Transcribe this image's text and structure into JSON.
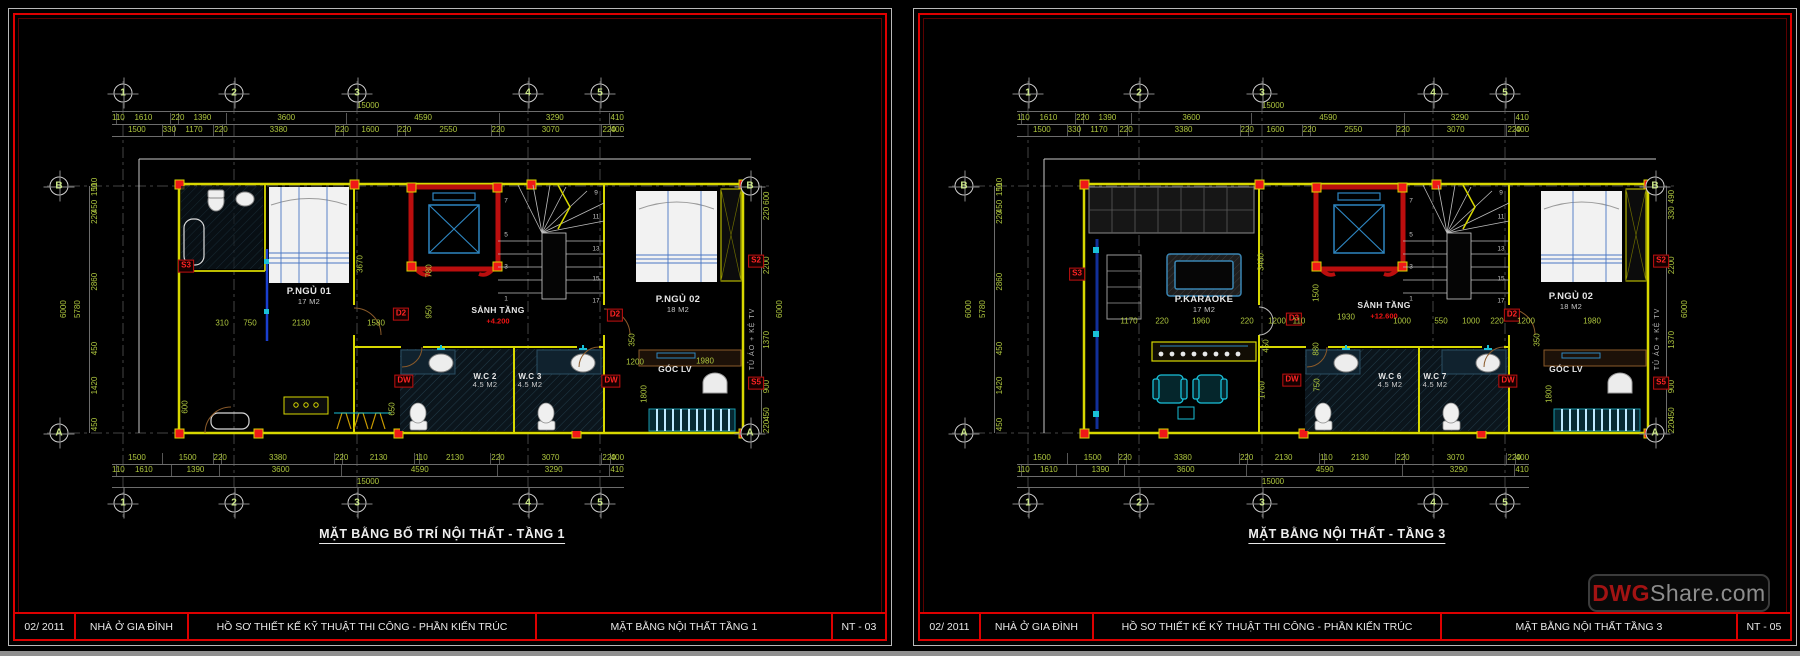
{
  "watermark": {
    "brand": "DWG",
    "suffix": "Share.com"
  },
  "sheets": {
    "left": {
      "plan_title": "MẶT BẰNG BỐ TRÍ NỘI THẤT -  TẦNG 1",
      "titleblock": {
        "date": "02/ 2011",
        "project": "NHÀ Ở GIA ĐÌNH",
        "dossier": "HỒ SƠ THIẾT KẾ KỸ THUẬT THI CÔNG  - PHẦN KIẾN TRÚC",
        "drawing": "MẶT BẰNG NỘI THẤT TẦNG 1",
        "number": "NT - 03"
      },
      "grid": {
        "cols": [
          "1",
          "2",
          "3",
          "4",
          "5"
        ],
        "rows": [
          "B",
          "A"
        ]
      },
      "dims": {
        "top_overall": "15000",
        "top_row2": [
          "110",
          "1610",
          "220",
          "1390",
          "3600",
          "4590",
          "3290",
          "410"
        ],
        "top_row3": [
          "1500",
          "330",
          "1170",
          "220",
          "3380",
          "220",
          "1600",
          "220",
          "2550",
          "220",
          "3070",
          "220",
          "400"
        ],
        "bottom_row1": [
          "1500",
          "1500",
          "220",
          "3380",
          "220",
          "2130",
          "110",
          "2130",
          "220",
          "3070",
          "220",
          "400"
        ],
        "bottom_row2": [
          "110",
          "1610",
          "1390",
          "3600",
          "4590",
          "3290",
          "410"
        ],
        "bottom_overall": "15000",
        "left_overall": [
          "6000",
          "5780"
        ],
        "left_chain": [
          "110",
          "150",
          "450",
          "220",
          "2860",
          "450",
          "1420",
          "450"
        ],
        "right_chain": [
          "600",
          "220",
          "2200",
          "1370",
          "900",
          "450",
          "220"
        ],
        "right_overall": [
          "6000"
        ]
      },
      "placed": [
        {
          "t": "P.NGỦ 01",
          "sub": "17 M2",
          "x": 300,
          "y": 288,
          "c": "room"
        },
        {
          "t": "SẢNH TẦNG",
          "x": 489,
          "y": 302,
          "c": "room small"
        },
        {
          "t": "+4.200",
          "x": 489,
          "y": 313,
          "c": "elev"
        },
        {
          "t": "W.C 2",
          "sub": "4.5 M2",
          "x": 476,
          "y": 372,
          "c": "room wc"
        },
        {
          "t": "W.C 3",
          "sub": "4.5 M2",
          "x": 521,
          "y": 372,
          "c": "room wc"
        },
        {
          "t": "P.NGỦ 02",
          "sub": "18 M2",
          "x": 669,
          "y": 296,
          "c": "room"
        },
        {
          "t": "GÓC LV",
          "x": 666,
          "y": 361,
          "c": "room small"
        },
        {
          "t": "S3",
          "x": 177,
          "y": 257,
          "c": "tag"
        },
        {
          "t": "D2",
          "x": 392,
          "y": 305,
          "c": "tag"
        },
        {
          "t": "D2",
          "x": 606,
          "y": 306,
          "c": "tag"
        },
        {
          "t": "DW",
          "x": 395,
          "y": 372,
          "c": "tag"
        },
        {
          "t": "DW",
          "x": 602,
          "y": 372,
          "c": "tag"
        },
        {
          "t": "S2",
          "x": 747,
          "y": 252,
          "c": "tag"
        },
        {
          "t": "S5",
          "x": 747,
          "y": 374,
          "c": "tag"
        },
        {
          "t": "310",
          "x": 213,
          "y": 314,
          "c": "pdim"
        },
        {
          "t": "750",
          "x": 241,
          "y": 314,
          "c": "pdim"
        },
        {
          "t": "2130",
          "x": 292,
          "y": 314,
          "c": "pdim"
        },
        {
          "t": "1580",
          "x": 367,
          "y": 314,
          "c": "pdim"
        },
        {
          "t": "1200",
          "x": 626,
          "y": 353,
          "c": "pdim"
        },
        {
          "t": "1980",
          "x": 696,
          "y": 352,
          "c": "pdim"
        },
        {
          "t": "3670",
          "x": 351,
          "y": 255,
          "r": 1,
          "c": "pdim"
        },
        {
          "t": "780",
          "x": 420,
          "y": 262,
          "r": 1,
          "c": "pdim"
        },
        {
          "t": "950",
          "x": 420,
          "y": 303,
          "r": 1,
          "c": "pdim"
        },
        {
          "t": "350",
          "x": 623,
          "y": 331,
          "r": 1,
          "c": "pdim"
        },
        {
          "t": "1800",
          "x": 635,
          "y": 385,
          "r": 1,
          "c": "pdim"
        },
        {
          "t": "650",
          "x": 383,
          "y": 400,
          "r": 1,
          "c": "pdim"
        },
        {
          "t": "600",
          "x": 176,
          "y": 398,
          "r": 1,
          "c": "pdim"
        },
        {
          "t": "1",
          "x": 497,
          "y": 290,
          "c": "snum"
        },
        {
          "t": "3",
          "x": 497,
          "y": 258,
          "c": "snum"
        },
        {
          "t": "5",
          "x": 497,
          "y": 226,
          "c": "snum"
        },
        {
          "t": "7",
          "x": 497,
          "y": 192,
          "c": "snum"
        },
        {
          "t": "9",
          "x": 587,
          "y": 184,
          "c": "snum"
        },
        {
          "t": "11",
          "x": 587,
          "y": 208,
          "c": "snum"
        },
        {
          "t": "13",
          "x": 587,
          "y": 240,
          "c": "snum"
        },
        {
          "t": "15",
          "x": 587,
          "y": 270,
          "c": "snum"
        },
        {
          "t": "17",
          "x": 587,
          "y": 292,
          "c": "snum"
        },
        {
          "t": "TỦ ÁO + KỆ TV",
          "x": 744,
          "y": 330,
          "r": 1,
          "c": "note"
        }
      ]
    },
    "right": {
      "plan_title": "MẶT BẰNG NỘI THẤT -  TẦNG 3",
      "titleblock": {
        "date": "02/ 2011",
        "project": "NHÀ Ở GIA ĐÌNH",
        "dossier": "HỒ SƠ THIẾT KẾ KỸ THUẬT THI CÔNG  - PHẦN KIẾN TRÚC",
        "drawing": "MẶT BẰNG NỘI THẤT TẦNG 3",
        "number": "NT - 05"
      },
      "grid": {
        "cols": [
          "1",
          "2",
          "3",
          "4",
          "5"
        ],
        "rows": [
          "B",
          "A"
        ]
      },
      "dims": {
        "top_overall": "15000",
        "top_row2": [
          "110",
          "1610",
          "220",
          "1390",
          "3600",
          "4590",
          "3290",
          "410"
        ],
        "top_row3": [
          "1500",
          "330",
          "1170",
          "220",
          "3380",
          "220",
          "1600",
          "220",
          "2550",
          "220",
          "3070",
          "220",
          "400"
        ],
        "bottom_row1": [
          "1500",
          "1500",
          "220",
          "3380",
          "220",
          "2130",
          "110",
          "2130",
          "220",
          "3070",
          "220",
          "400"
        ],
        "bottom_row2": [
          "110",
          "1610",
          "1390",
          "3600",
          "4590",
          "3290",
          "410"
        ],
        "bottom_overall": "15000",
        "left_overall": [
          "6000",
          "5780"
        ],
        "left_chain": [
          "110",
          "150",
          "450",
          "220",
          "2860",
          "450",
          "1420",
          "450"
        ],
        "right_chain": [
          "490",
          "330",
          "2200",
          "1370",
          "900",
          "450",
          "220"
        ],
        "right_overall": [
          "6000"
        ]
      },
      "placed": [
        {
          "t": "P.KARAOKE",
          "sub": "17 M2",
          "x": 290,
          "y": 296,
          "c": "room"
        },
        {
          "t": "SẢNH TẦNG",
          "x": 470,
          "y": 297,
          "c": "room small"
        },
        {
          "t": "+12.600",
          "x": 470,
          "y": 308,
          "c": "elev"
        },
        {
          "t": "W.C 6",
          "sub": "4.5 M2",
          "x": 476,
          "y": 372,
          "c": "room wc"
        },
        {
          "t": "W.C 7",
          "sub": "4.5 M2",
          "x": 521,
          "y": 372,
          "c": "room wc"
        },
        {
          "t": "P.NGỦ 02",
          "sub": "18 M2",
          "x": 657,
          "y": 293,
          "c": "room"
        },
        {
          "t": "GÓC LV",
          "x": 652,
          "y": 361,
          "c": "room small"
        },
        {
          "t": "S3",
          "x": 163,
          "y": 265,
          "c": "tag"
        },
        {
          "t": "D3",
          "x": 380,
          "y": 310,
          "c": "tag"
        },
        {
          "t": "D2",
          "x": 598,
          "y": 306,
          "c": "tag"
        },
        {
          "t": "DW",
          "x": 378,
          "y": 371,
          "c": "tag"
        },
        {
          "t": "DW",
          "x": 594,
          "y": 372,
          "c": "tag"
        },
        {
          "t": "S2",
          "x": 747,
          "y": 252,
          "c": "tag"
        },
        {
          "t": "S5",
          "x": 747,
          "y": 374,
          "c": "tag"
        },
        {
          "t": "1170",
          "x": 215,
          "y": 312,
          "c": "pdim"
        },
        {
          "t": "220",
          "x": 248,
          "y": 312,
          "c": "pdim"
        },
        {
          "t": "1960",
          "x": 287,
          "y": 312,
          "c": "pdim"
        },
        {
          "t": "220",
          "x": 333,
          "y": 312,
          "c": "pdim"
        },
        {
          "t": "1200",
          "x": 363,
          "y": 312,
          "c": "pdim"
        },
        {
          "t": "110",
          "x": 385,
          "y": 312,
          "c": "pdim"
        },
        {
          "t": "1930",
          "x": 432,
          "y": 308,
          "c": "pdim"
        },
        {
          "t": "1000",
          "x": 488,
          "y": 312,
          "c": "pdim"
        },
        {
          "t": "550",
          "x": 527,
          "y": 312,
          "c": "pdim"
        },
        {
          "t": "1000",
          "x": 557,
          "y": 312,
          "c": "pdim"
        },
        {
          "t": "220",
          "x": 583,
          "y": 312,
          "c": "pdim"
        },
        {
          "t": "1200",
          "x": 612,
          "y": 312,
          "c": "pdim"
        },
        {
          "t": "1980",
          "x": 678,
          "y": 312,
          "c": "pdim"
        },
        {
          "t": "3460",
          "x": 347,
          "y": 253,
          "r": 1,
          "c": "pdim"
        },
        {
          "t": "1500",
          "x": 402,
          "y": 284,
          "r": 1,
          "c": "pdim"
        },
        {
          "t": "450",
          "x": 352,
          "y": 337,
          "r": 1,
          "c": "pdim"
        },
        {
          "t": "880",
          "x": 402,
          "y": 340,
          "r": 1,
          "c": "pdim"
        },
        {
          "t": "750",
          "x": 403,
          "y": 376,
          "r": 1,
          "c": "pdim"
        },
        {
          "t": "1760",
          "x": 348,
          "y": 381,
          "r": 1,
          "c": "pdim"
        },
        {
          "t": "350",
          "x": 623,
          "y": 331,
          "r": 1,
          "c": "pdim"
        },
        {
          "t": "1800",
          "x": 635,
          "y": 385,
          "r": 1,
          "c": "pdim"
        },
        {
          "t": "1",
          "x": 497,
          "y": 290,
          "c": "snum"
        },
        {
          "t": "3",
          "x": 497,
          "y": 258,
          "c": "snum"
        },
        {
          "t": "5",
          "x": 497,
          "y": 226,
          "c": "snum"
        },
        {
          "t": "7",
          "x": 497,
          "y": 192,
          "c": "snum"
        },
        {
          "t": "9",
          "x": 587,
          "y": 184,
          "c": "snum"
        },
        {
          "t": "11",
          "x": 587,
          "y": 208,
          "c": "snum"
        },
        {
          "t": "13",
          "x": 587,
          "y": 240,
          "c": "snum"
        },
        {
          "t": "15",
          "x": 587,
          "y": 270,
          "c": "snum"
        },
        {
          "t": "17",
          "x": 587,
          "y": 292,
          "c": "snum"
        },
        {
          "t": "TỦ ÁO + KỆ TV",
          "x": 744,
          "y": 330,
          "r": 1,
          "c": "note"
        }
      ]
    }
  }
}
